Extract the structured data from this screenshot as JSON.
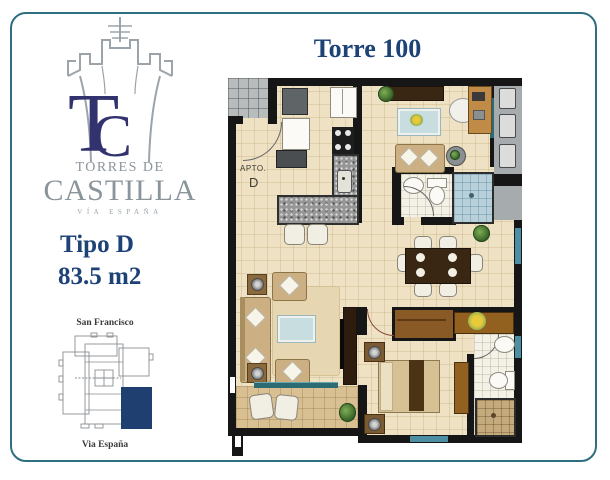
{
  "card": {
    "border_color": "#2d6f80",
    "background": "#ffffff"
  },
  "logo": {
    "castle_icon": "castle-tower-line-art",
    "monogram_t": "T",
    "monogram_c": "C",
    "monogram_color": "#32326e",
    "name_line1": "TORRES DE",
    "name_line2": "CASTILLA",
    "tagline": "VÍA ESPAÑA",
    "text_color": "#8a949b"
  },
  "unit": {
    "type": "Tipo D",
    "area": "83.5 m2",
    "accent_color": "#1c4276"
  },
  "tower": {
    "title": "Torre 100",
    "accent_color": "#1c4276"
  },
  "site_map": {
    "north_label": "San Francisco",
    "south_label": "Via España",
    "highlight_color": "#1e3f70",
    "outline_color": "#8a8f94"
  },
  "floor_plan": {
    "unit_label": "APTO.",
    "unit_letter": "D",
    "wall_color": "#161616",
    "floor_color": "#efe2c4",
    "balcony_rail_color": "#2d6b74",
    "shower_tile_color": "#b7d0da"
  }
}
